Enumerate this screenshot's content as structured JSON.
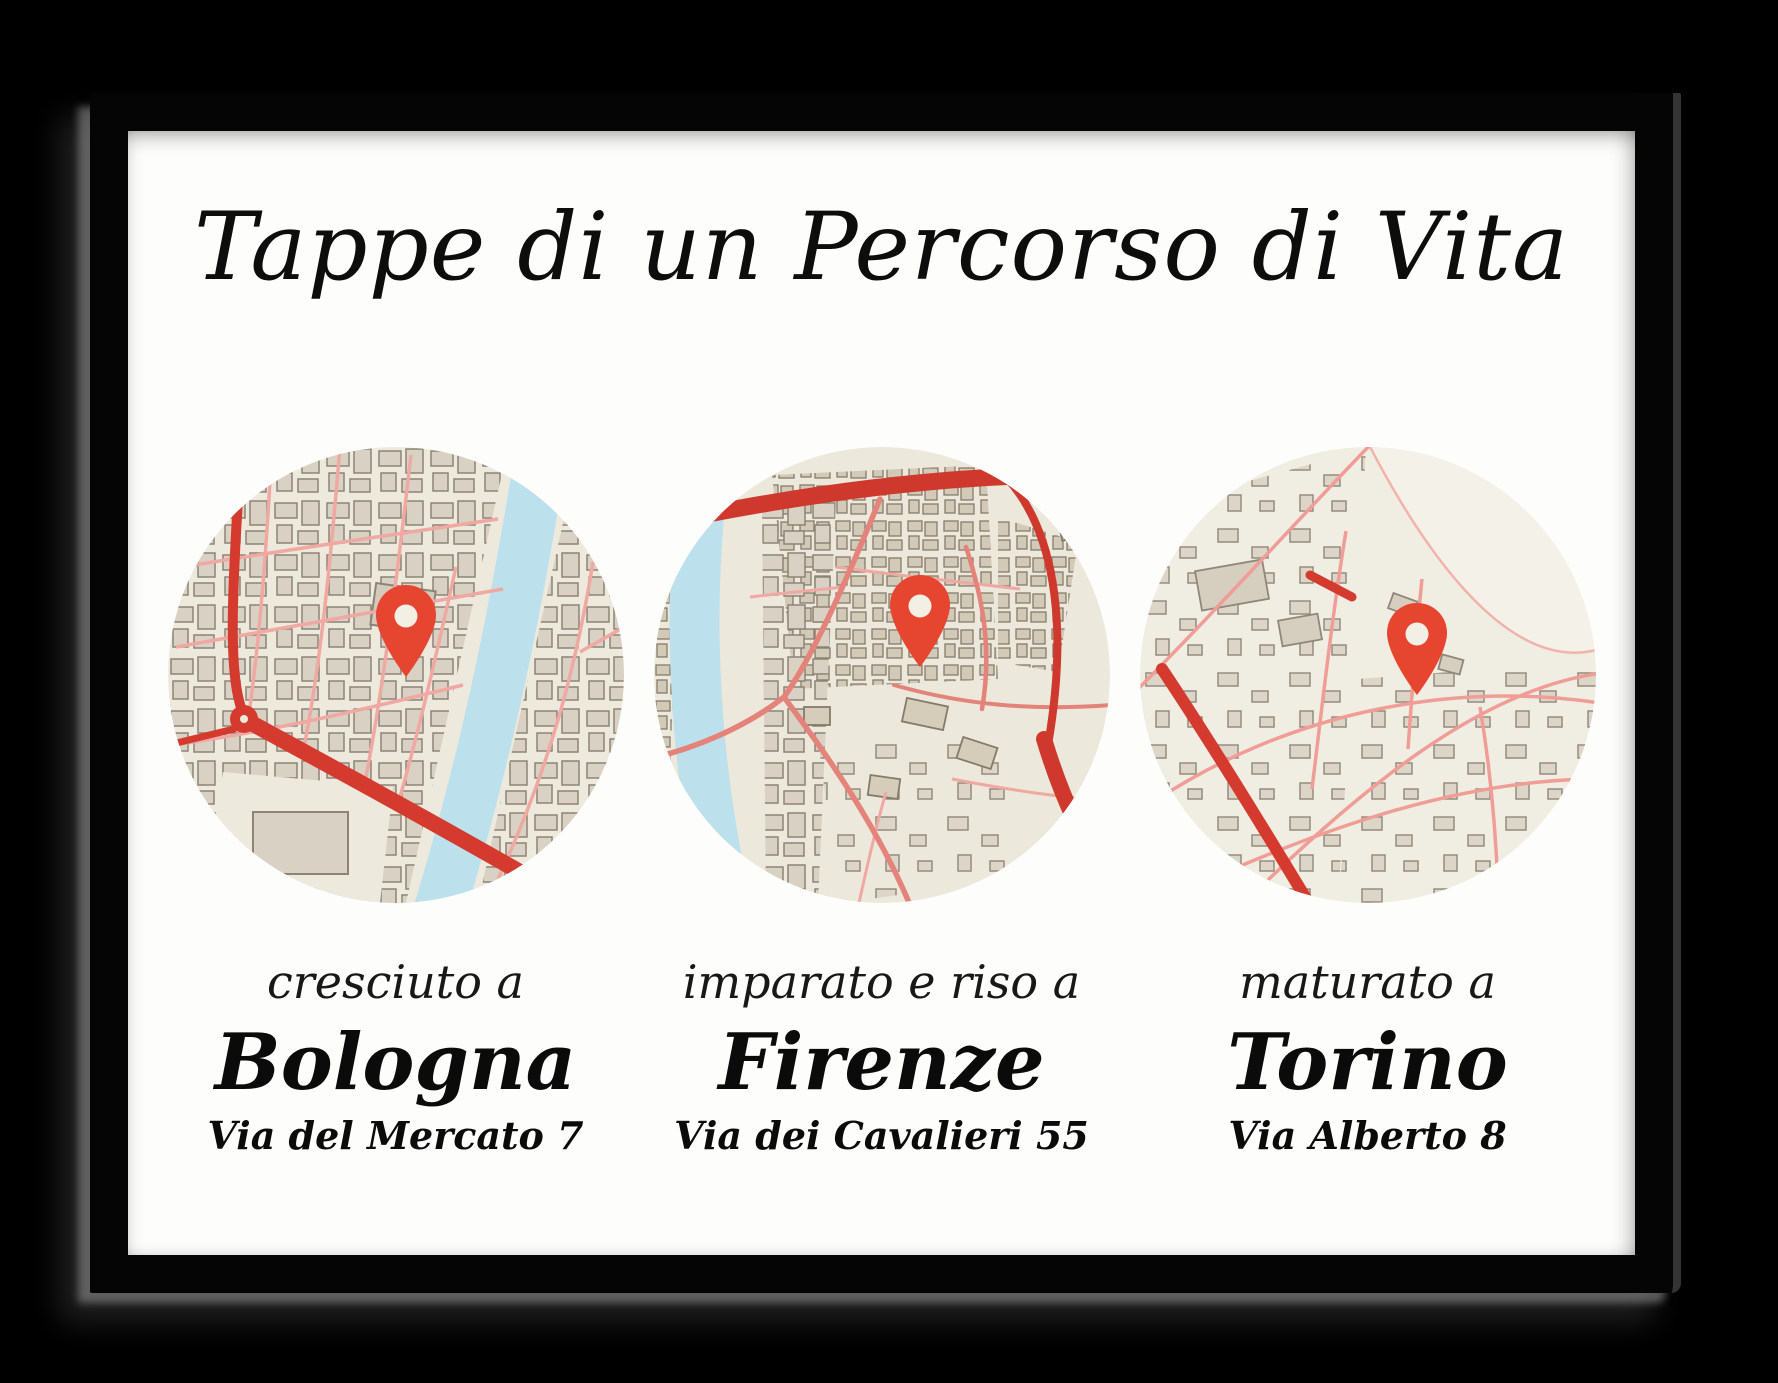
{
  "poster": {
    "title": "Tappe di un Percorso di Vita",
    "locations": [
      {
        "caption": "cresciuto a",
        "city": "Bologna",
        "address": "Via del Mercato 7"
      },
      {
        "caption": "imparato e riso a",
        "city": "Firenze",
        "address": "Via dei Cavalieri 55"
      },
      {
        "caption": "maturato a",
        "city": "Torino",
        "address": "Via Alberto 8"
      }
    ],
    "icons": {
      "pin": "location-pin-icon"
    },
    "colors": {
      "pin": "#e64530",
      "map_background": "#ede9dd",
      "water": "#bde1ec",
      "road_major": "#d43a2e",
      "road_minor": "#f0a8a2",
      "building_fill": "#d9d2c4",
      "building_stroke": "#8c8476",
      "frame": "#000000",
      "poster_background": "#fdfdfc",
      "text": "#0d0d0d"
    }
  }
}
